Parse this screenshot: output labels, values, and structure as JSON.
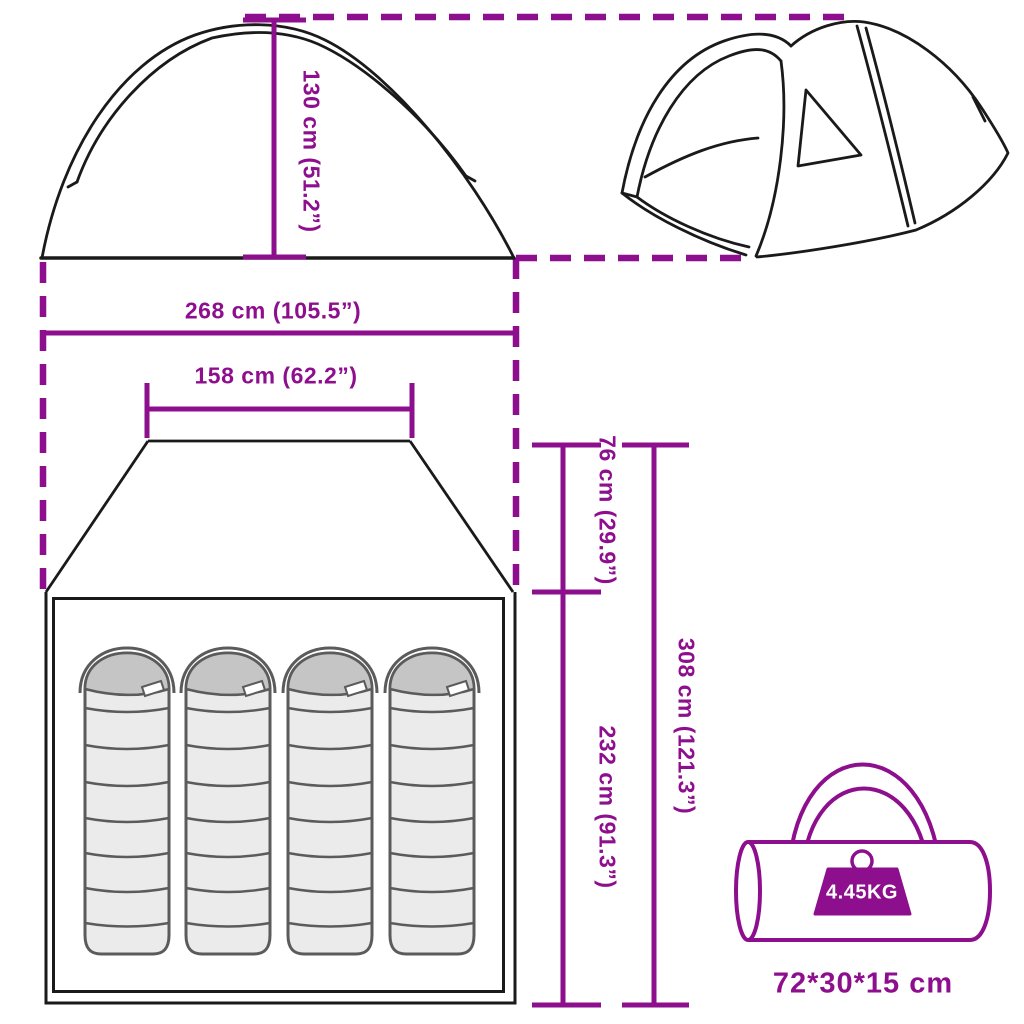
{
  "diagram": {
    "accent_color": "#8E0F8E",
    "line_color": "#1a1a1a",
    "dimensions": {
      "height": "130 cm (51.2”)",
      "outer_width": "268 cm (105.5”)",
      "inner_width": "158 cm (62.2”)",
      "porch_depth": "76 cm (29.9”)",
      "inner_length": "232 cm (91.3”)",
      "total_length": "308 cm (121.3”)"
    },
    "package": {
      "weight": "4.45KG",
      "size": "72*30*15 cm"
    },
    "icons": {
      "tent_side_view": "tent-side-view-icon",
      "tent_3d": "tent-3d-icon",
      "sleeping_bag": "sleeping-bag-icon",
      "carry_bag": "carry-bag-icon",
      "weight": "weight-icon"
    }
  }
}
